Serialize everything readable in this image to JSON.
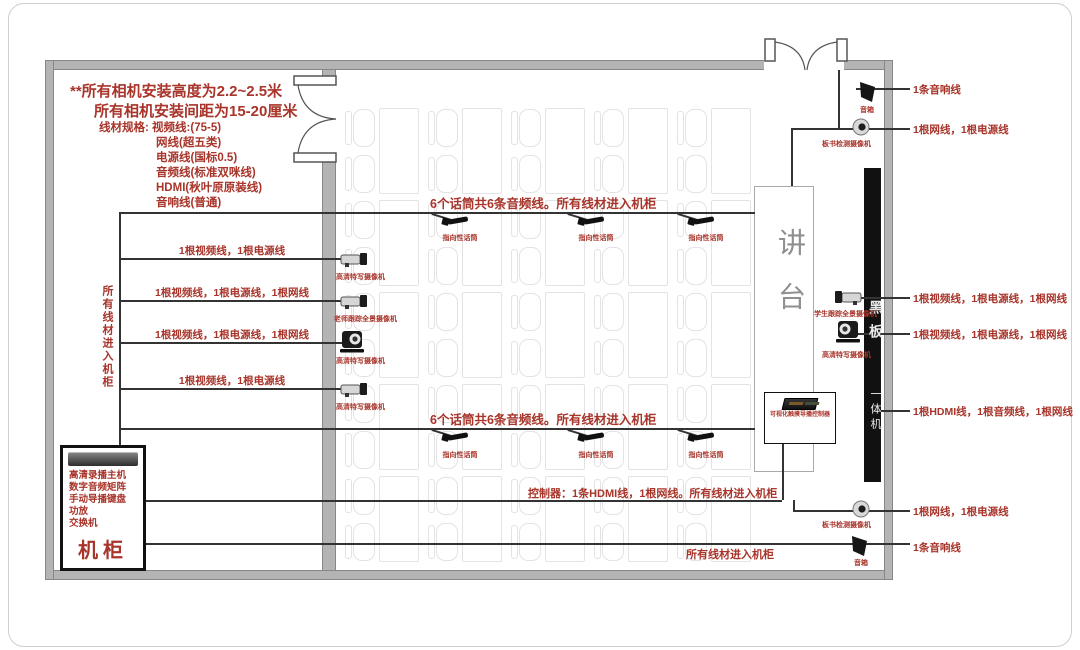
{
  "header": {
    "line1": "**所有相机安装高度为2.2~2.5米",
    "line2": "所有相机安装间距为15-20厘米"
  },
  "cable_specs": {
    "label": "线材规格:",
    "items": [
      "视频线:(75-5)",
      "网线(超五类)",
      "电源线(国标0.5)",
      "音频线(标准双咪线)",
      "HDMI(秋叶原原装线)",
      "音响线(普通)"
    ]
  },
  "left_wall": {
    "trunk_note": "所有线材进入机柜",
    "cameras": [
      {
        "label": "高清特写摄像机",
        "cable": "1根视频线，1根电源线"
      },
      {
        "label": "老师跟踪全景摄像机",
        "cable": "1根视频线，1根电源线，1根网线"
      },
      {
        "label": "高清特写摄像机",
        "cable": "1根视频线，1根电源线，1根网线"
      },
      {
        "label": "高清特写摄像机",
        "cable": "1根视频线，1根电源线"
      }
    ]
  },
  "mics": {
    "bus_note": "6个话筒共6条音频线。所有线材进入机柜",
    "label": "指向性话筒"
  },
  "notes": {
    "controller": "控制器：1条HDMI线，1根网线。所有线材进入机柜",
    "bottom": "所有线材进入机柜"
  },
  "cabinet": {
    "items": [
      "高清录播主机",
      "数字音频矩阵",
      "手动导播键盘",
      "功放",
      "交换机"
    ],
    "title": "机柜"
  },
  "podium": {
    "label": "讲台",
    "panel_label": "可视化触摸导播控制器"
  },
  "blackboard": {
    "top": "黑板",
    "bottom": "一体机"
  },
  "right_wall": {
    "speaker_top": {
      "label": "音箱",
      "cable": "1条音响线"
    },
    "dome_top": {
      "label": "板书检测摄像机",
      "cable": "1根网线，1根电源线"
    },
    "cam_student": {
      "label": "学生跟踪全景摄像机",
      "cable": "1根视频线，1根电源线，1根网线"
    },
    "cam_closeup": {
      "label": "高清特写摄像机",
      "cable": "1根视频线，1根电源线，1根网线"
    },
    "board_cable": "1根HDMI线，1根音频线，1根网线",
    "dome_bottom": {
      "label": "板书检测摄像机",
      "cable": "1根网线，1根电源线"
    },
    "speaker_bottom": {
      "label": "音箱",
      "cable": "1条音响线"
    }
  },
  "colors": {
    "annotation_red": "#a8342a",
    "wall_gray": "#b4b4b4",
    "line_dark": "#333333",
    "desk_outline": "#e3e3e3",
    "blackboard": "#111111"
  }
}
